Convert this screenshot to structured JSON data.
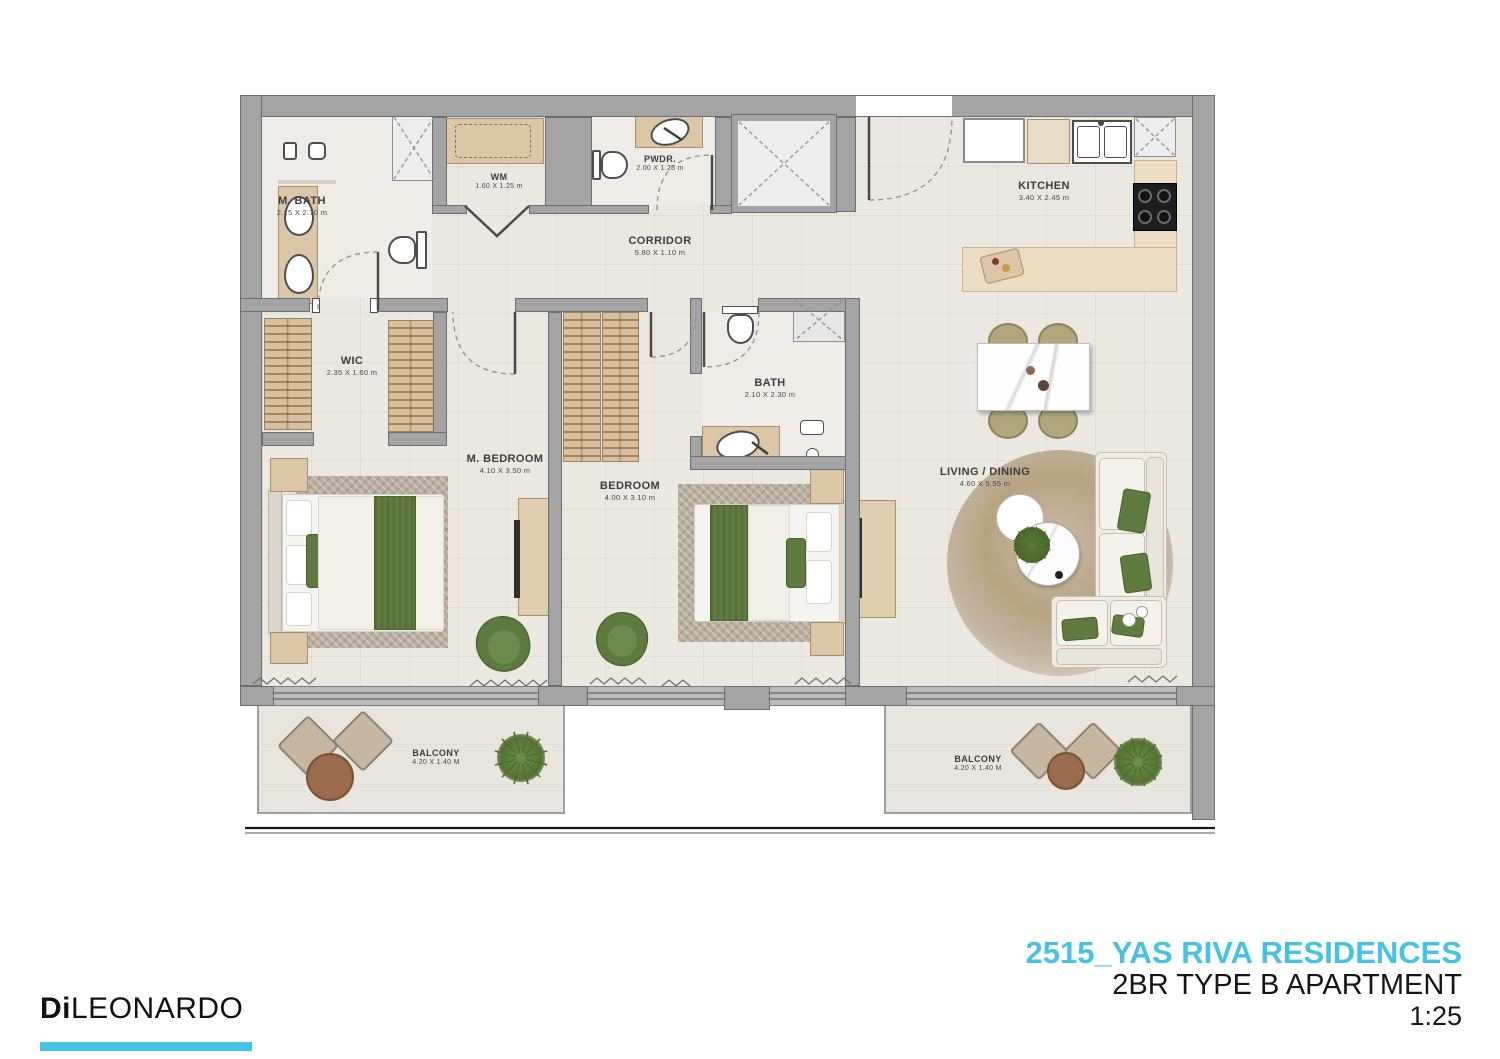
{
  "title_block": {
    "project": "2515_YAS RIVA RESIDENCES",
    "unit": "2BR TYPE B APARTMENT",
    "scale": "1:25"
  },
  "logo": {
    "bold": "Di",
    "light": "LEONARDO"
  },
  "colors": {
    "accent": "#45C2E6",
    "wall": "#a4a4a4",
    "wood": "#dcc6a7",
    "green": "#5e7b40"
  },
  "rooms": {
    "m_bath": {
      "name": "M. BATH",
      "dims": "2.15 X 2.70 m"
    },
    "wm": {
      "name": "WM",
      "dims": "1.60 X 1.25 m"
    },
    "pwdr": {
      "name": "PWDR.",
      "dims": "2.00 X 1.25 m"
    },
    "kitchen": {
      "name": "KITCHEN",
      "dims": "3.40 X 2.45 m"
    },
    "corridor": {
      "name": "CORRIDOR",
      "dims": "5.80 X 1.10 m"
    },
    "wic": {
      "name": "WIC",
      "dims": "2.35 X 1.60 m"
    },
    "bath": {
      "name": "BATH",
      "dims": "2.10 X 2.30 m"
    },
    "m_bedroom": {
      "name": "M. BEDROOM",
      "dims": "4.10 X 3.50 m"
    },
    "bedroom": {
      "name": "BEDROOM",
      "dims": "4.00 X 3.10 m"
    },
    "living": {
      "name": "LIVING / DINING",
      "dims": "4.60 X 5.55 m"
    },
    "balcony_left": {
      "name": "BALCONY",
      "dims": "4.20 X 1.40 M"
    },
    "balcony_right": {
      "name": "BALCONY",
      "dims": "4.20 X 1.40 M"
    }
  }
}
